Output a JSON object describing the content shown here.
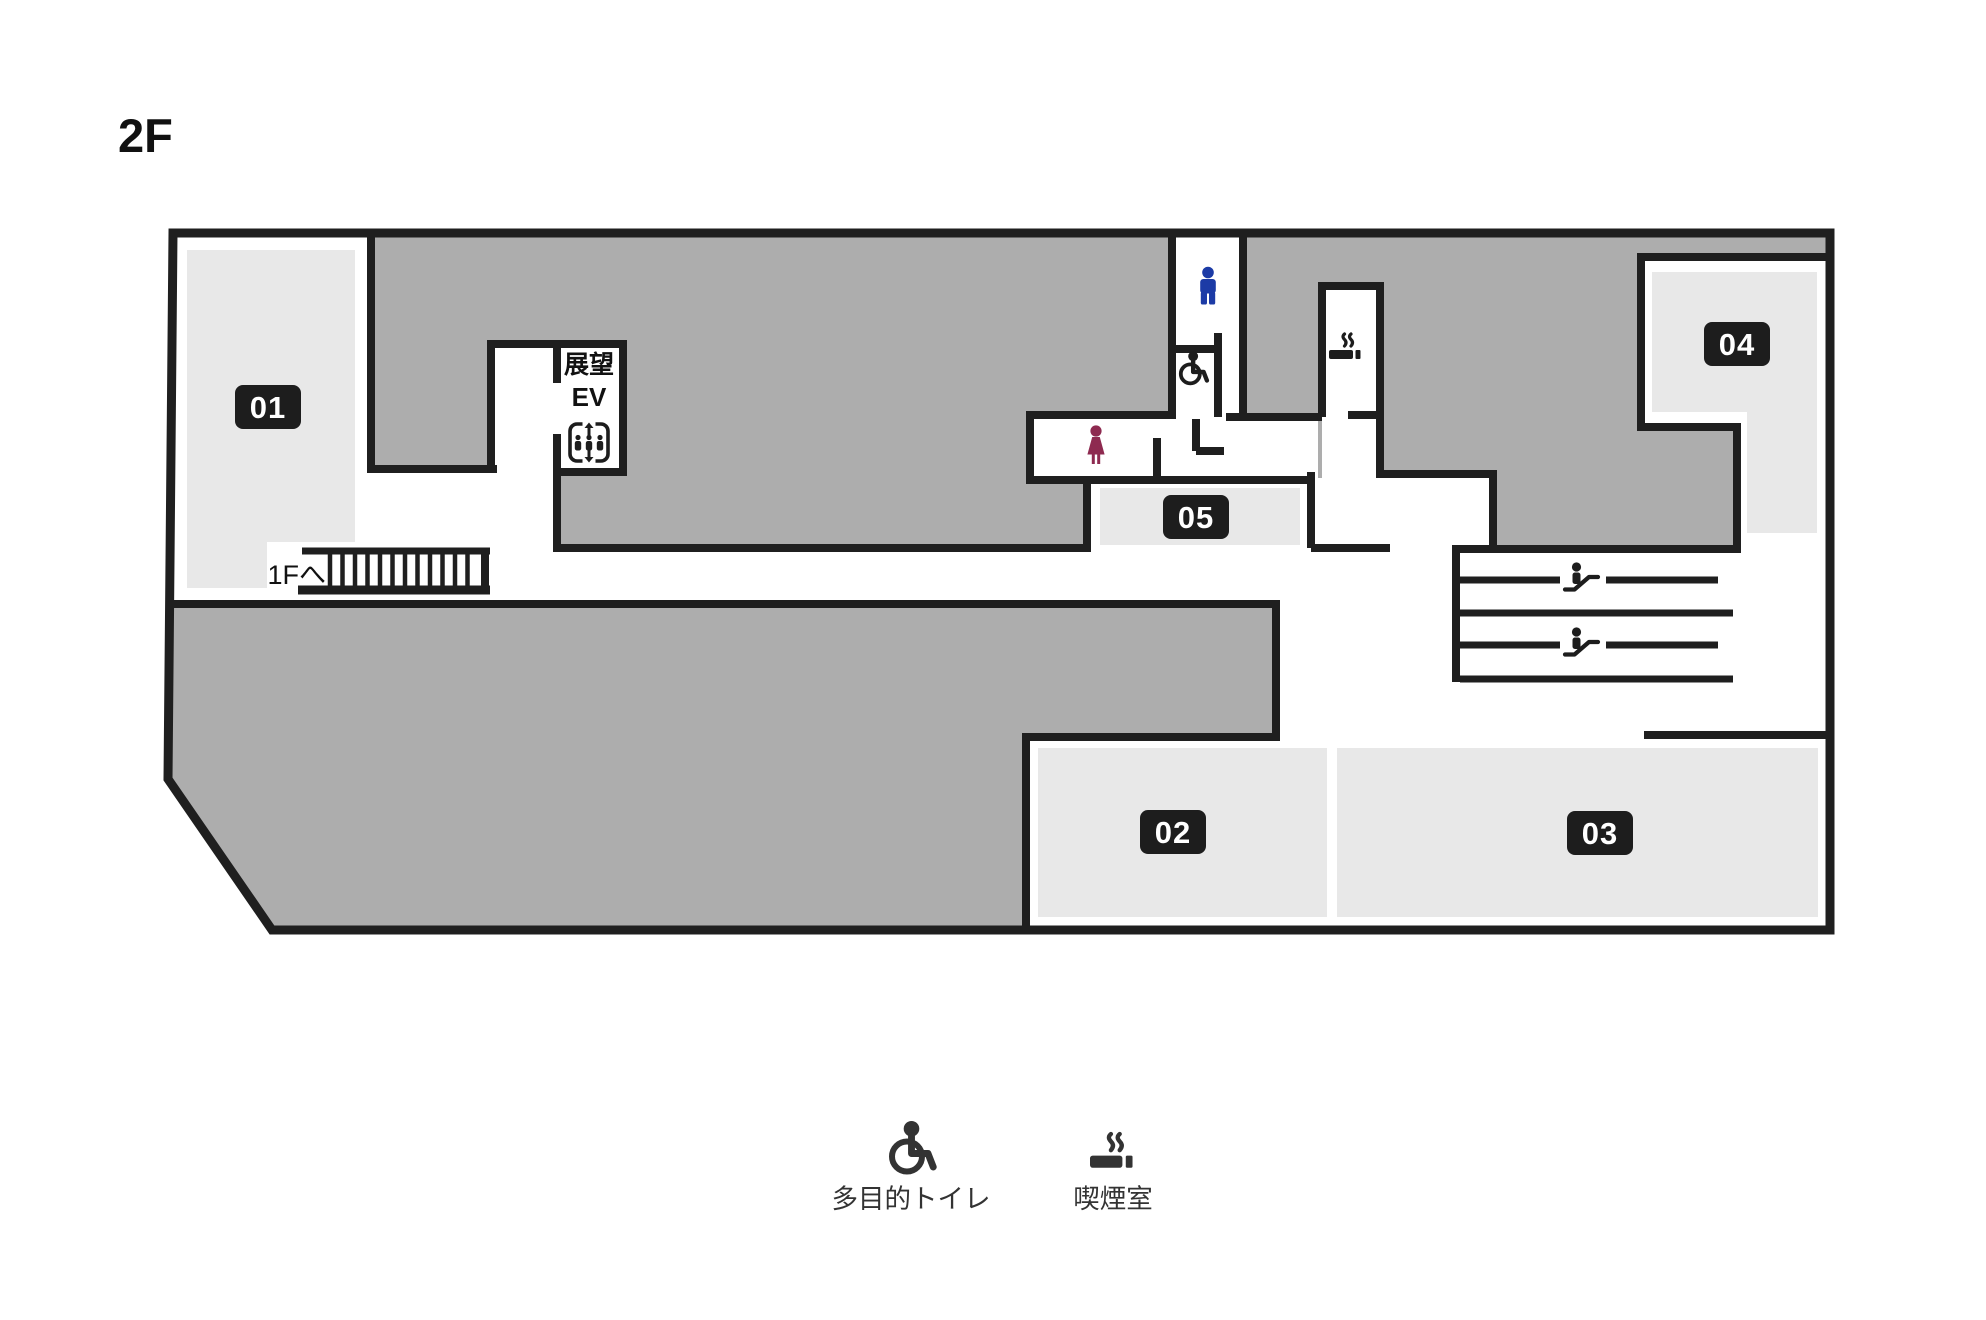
{
  "title": "2F",
  "map": {
    "rooms": [
      {
        "id": "01"
      },
      {
        "id": "02"
      },
      {
        "id": "03"
      },
      {
        "id": "04"
      },
      {
        "id": "05"
      }
    ],
    "elevator": {
      "line1": "展望",
      "line2": "EV"
    },
    "stairs_label": "1Fへ"
  },
  "legend": [
    {
      "icon": "wheelchair-icon",
      "label": "多目的トイレ"
    },
    {
      "icon": "smoking-icon",
      "label": "喫煙室"
    }
  ],
  "colors": {
    "wall": "#1f1f1f",
    "area_dark": "#adadad",
    "area_light": "#e8e8e8",
    "label_bg": "#1d1d1d",
    "men": "#1c3ba6",
    "women": "#8e2a50",
    "legend_icon": "#333333"
  }
}
